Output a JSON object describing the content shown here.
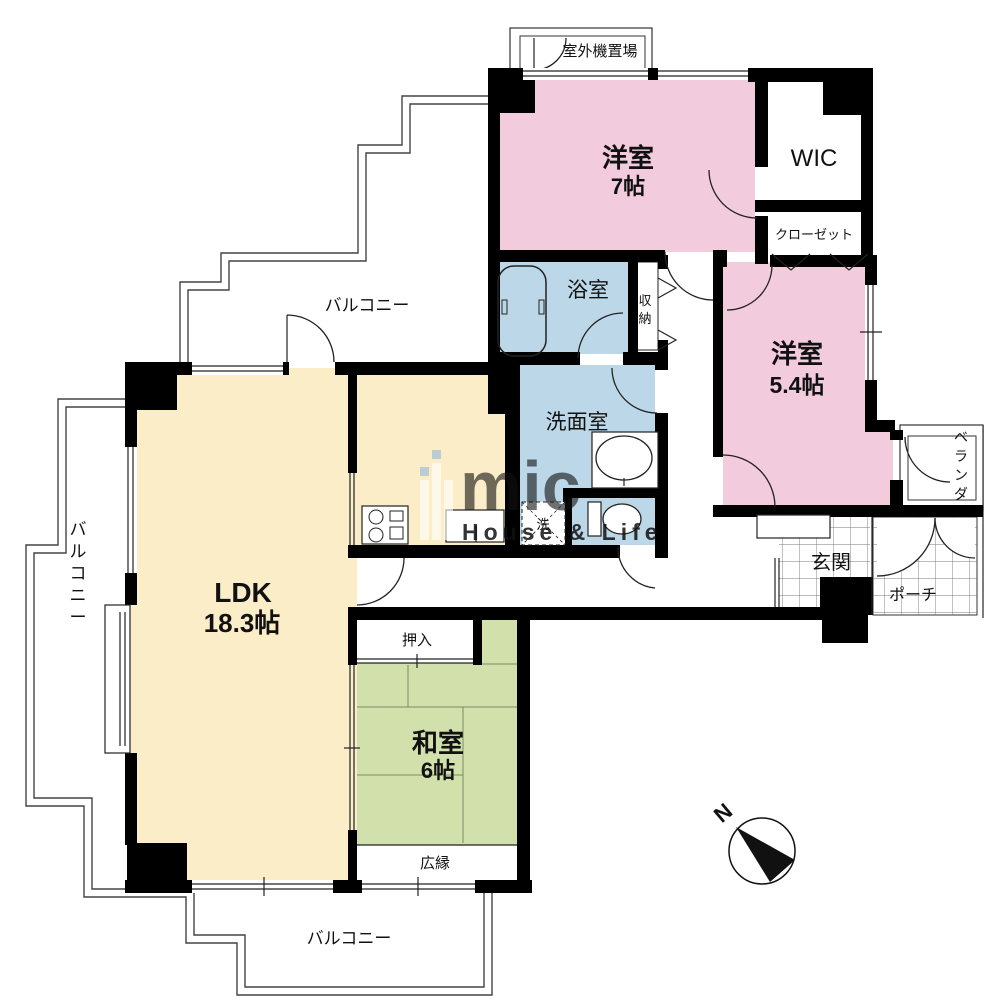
{
  "labels": {
    "outdoor_unit": "室外機置場",
    "western7_name": "洋室",
    "western7_size": "7帖",
    "wic": "WIC",
    "closet": "クローゼット",
    "western54_name": "洋室",
    "western54_size": "5.4帖",
    "bath": "浴室",
    "storage": "収納",
    "washroom": "洗面室",
    "laundry": "洗",
    "ldk_name": "LDK",
    "ldk_size": "18.3帖",
    "oshiire": "押入",
    "japanese_name": "和室",
    "japanese_size": "6帖",
    "hiroen": "広縁",
    "genkan": "玄関",
    "porch": "ポーチ",
    "veranda": "ベランダ",
    "balcony_top": "バルコニー",
    "balcony_left": "バルコニー",
    "balcony_bottom": "バルコニー",
    "compass_n": "N"
  },
  "watermark": {
    "brand": "mic",
    "tagline": "House & Life"
  },
  "colors": {
    "western_room": "#f2cbdc",
    "wet_room": "#bcd8e8",
    "ldk": "#fbedc8",
    "tatami": "#d2e0ac",
    "wall": "#000000",
    "watermark_blue": "#9bbedd"
  }
}
